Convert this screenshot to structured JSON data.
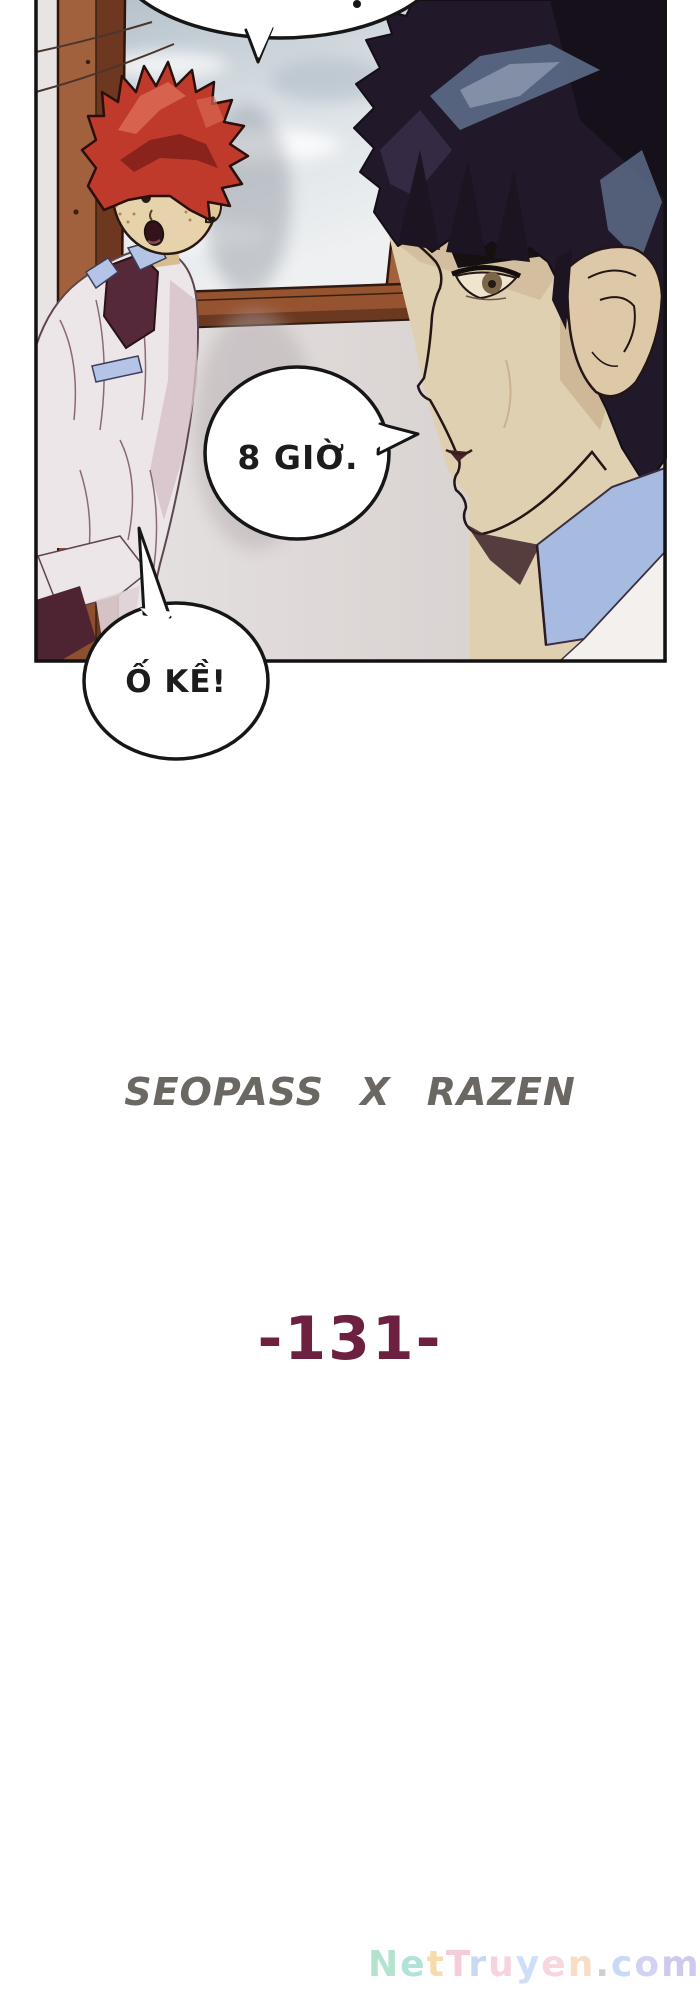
{
  "page": {
    "background": "#ffffff"
  },
  "panel": {
    "speech_bubbles": {
      "time_text": "8 GIỜ.",
      "ok_text": "Ố KỀ!"
    }
  },
  "credits": {
    "collaboration": "SEOPASS X RAZEN",
    "chapter_number": "-131-"
  },
  "colors": {
    "collaboration": "#6b6763",
    "chapter_number": "#6e2040",
    "bubble_outline": "#161616",
    "window_frame_light": "#a2613d",
    "window_frame_dark": "#6d381f",
    "red_hair": "#bf3a2b",
    "dark_hair": "#211829"
  },
  "watermark": {
    "text": "NetTruyen.com",
    "letters": [
      {
        "ch": "N",
        "color": "#69c89a"
      },
      {
        "ch": "e",
        "color": "#66c6b4"
      },
      {
        "ch": "t",
        "color": "#f0b660"
      },
      {
        "ch": "T",
        "color": "#ef9aae"
      },
      {
        "ch": "r",
        "color": "#92b4e8"
      },
      {
        "ch": "u",
        "color": "#f0a8c4"
      },
      {
        "ch": "y",
        "color": "#9cc0ee"
      },
      {
        "ch": "e",
        "color": "#f2aebe"
      },
      {
        "ch": "n",
        "color": "#f0bc8e"
      },
      {
        "ch": ".",
        "color": "#9aa0ac"
      },
      {
        "ch": "c",
        "color": "#8fb6ec"
      },
      {
        "ch": "o",
        "color": "#a8a6e6"
      },
      {
        "ch": "m",
        "color": "#9f96dd"
      }
    ]
  }
}
